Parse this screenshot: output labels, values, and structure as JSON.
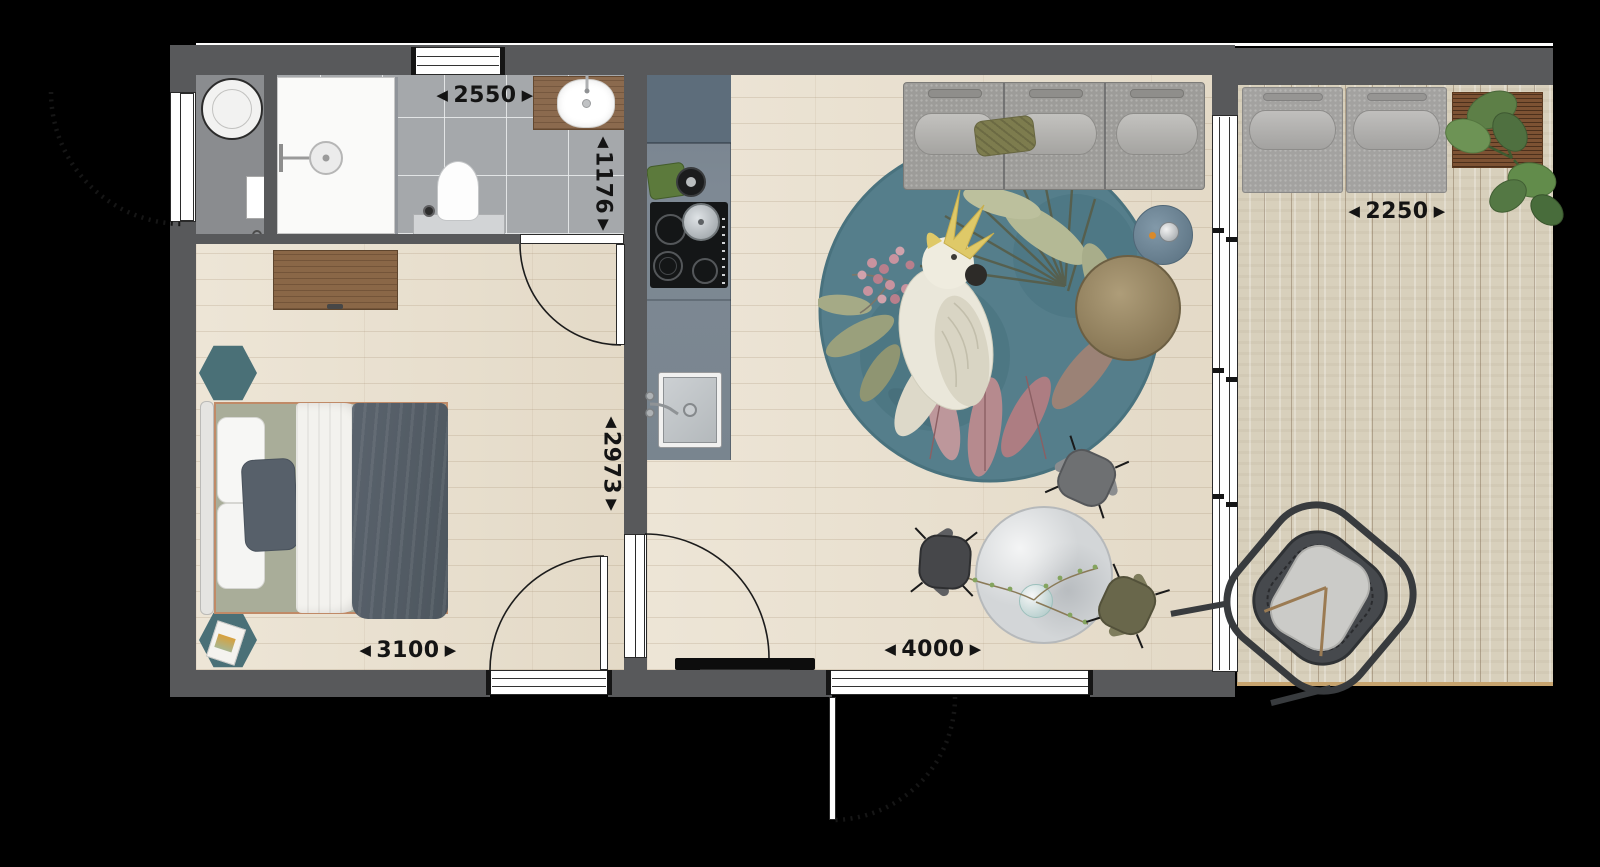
{
  "glyphs": {
    "arrow_left": "◀",
    "arrow_right": "▶",
    "arrow_up": "▲",
    "arrow_down": "▼"
  },
  "dimensions": {
    "bathroom_width": "2550",
    "bathroom_depth": "1176",
    "bedroom_depth": "2973",
    "bedroom_width": "3100",
    "living_width": "4000",
    "terrace_width": "2250"
  },
  "colors": {
    "background": "#000000",
    "wall": "#58595b",
    "wood_floor": "#e8decb",
    "tile_floor": "#a5a8ab",
    "deck_floor": "#d8d0bc",
    "kitchen_counter": "#7e8994",
    "accent_teal_table": "#4a7077",
    "rug_teal": "#557e8b",
    "sofa_gray": "#9d9c99",
    "blanket_slate": "#57606a",
    "bed_trim_copper": "#c08a67",
    "dresser_wood": "#8a6747",
    "dimension_text": "#141414"
  }
}
